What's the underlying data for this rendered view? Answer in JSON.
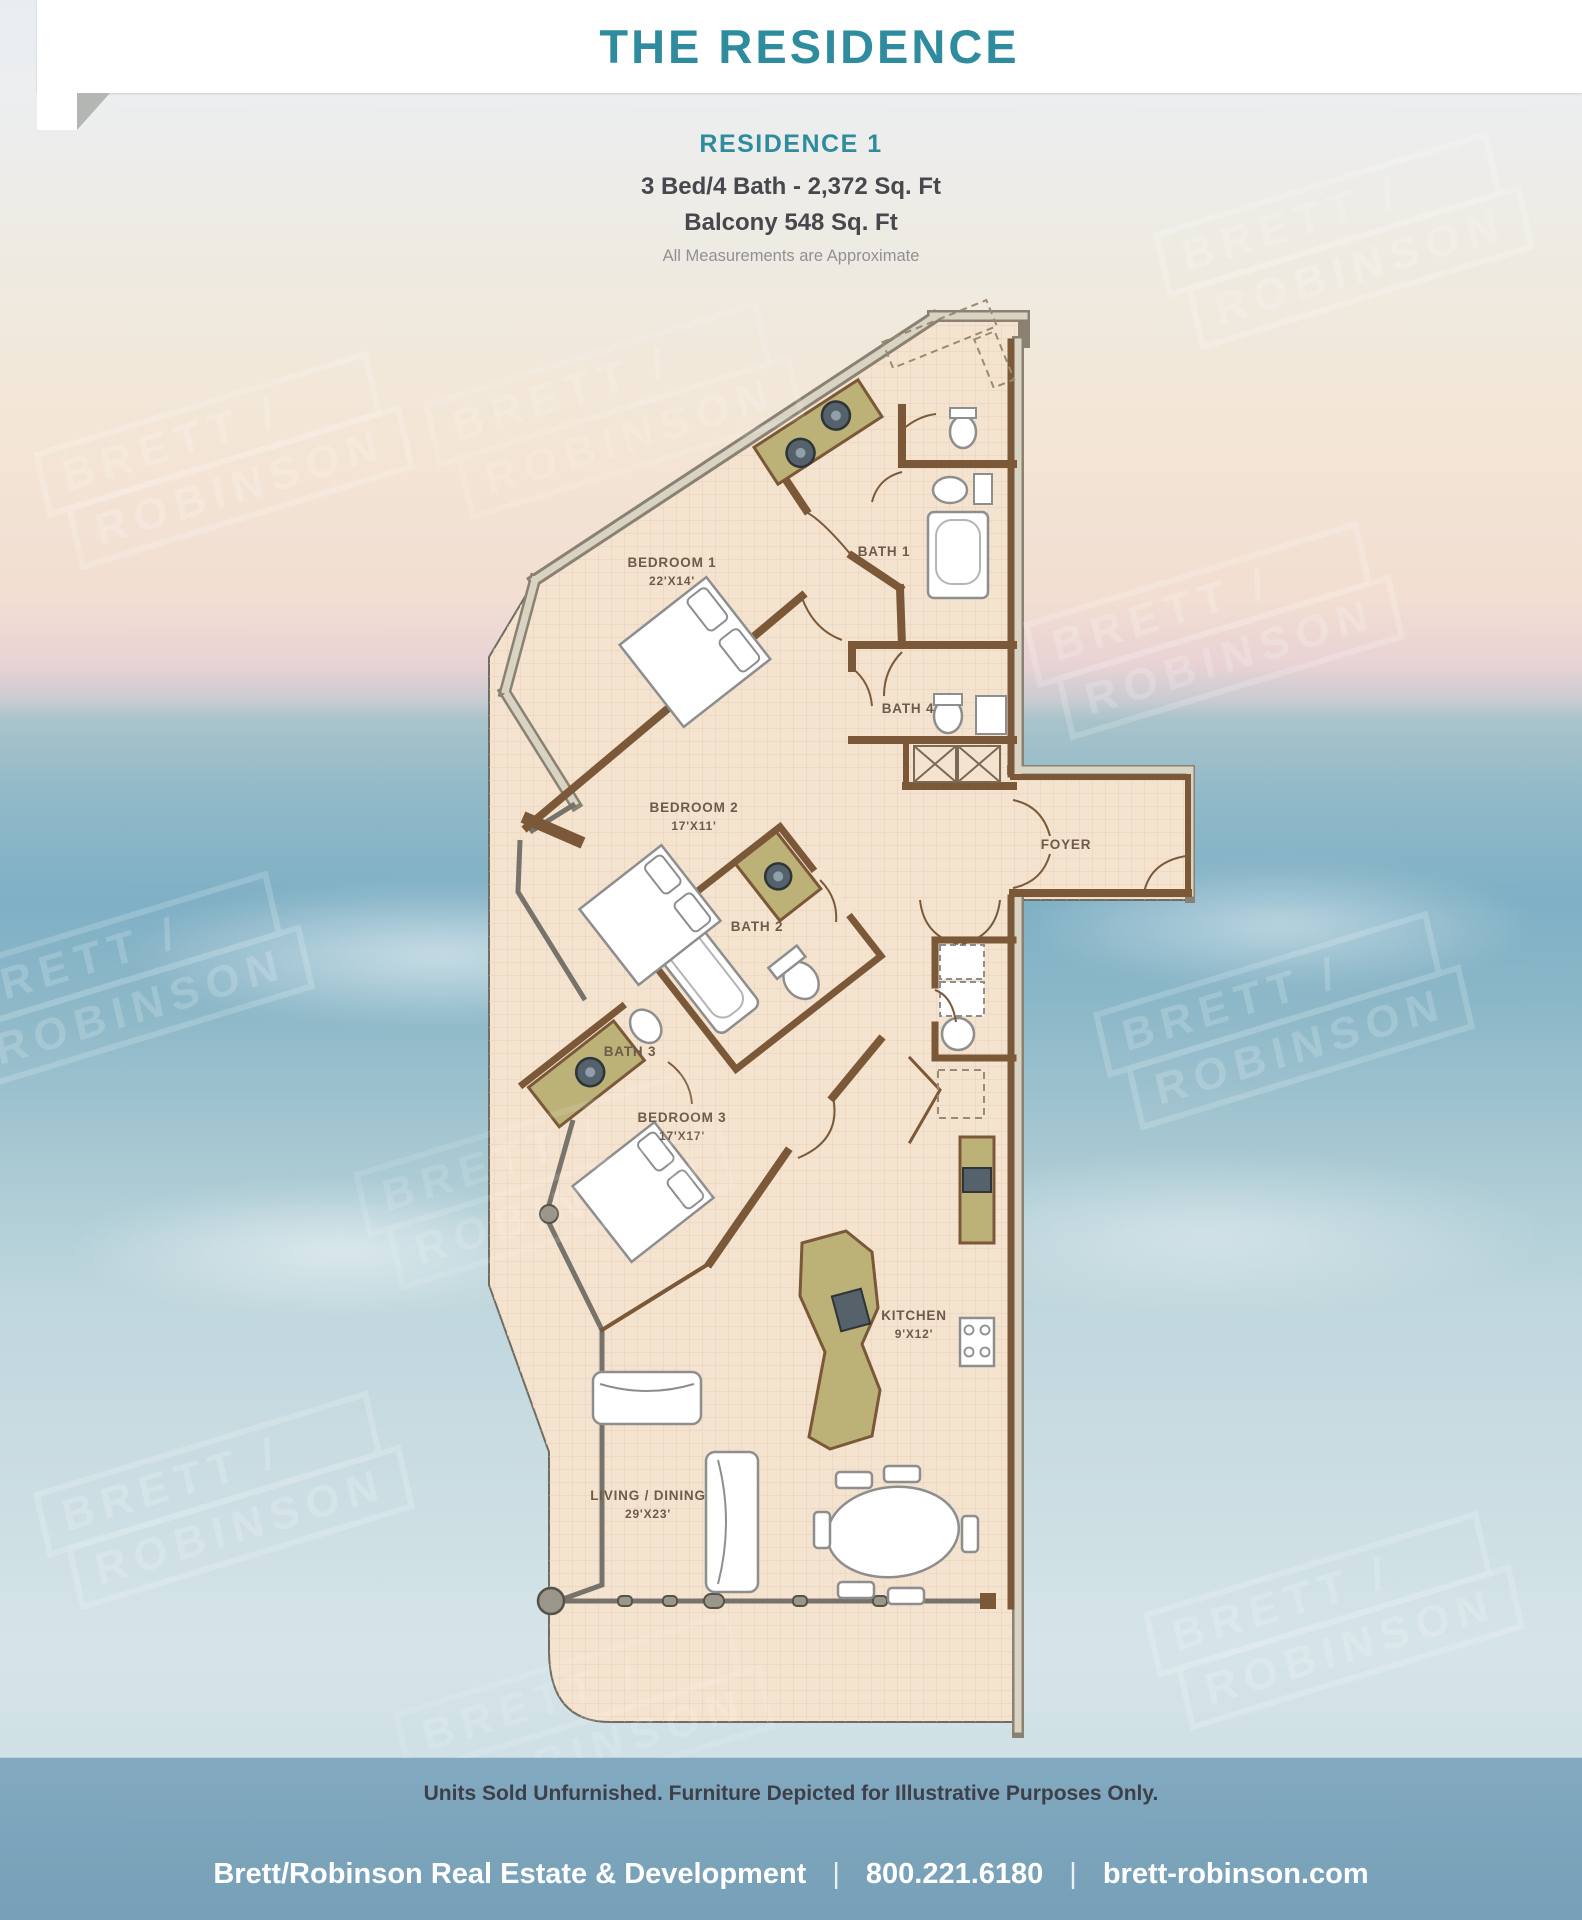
{
  "header": {
    "title": "THE RESIDENCE"
  },
  "intro": {
    "residence": "RESIDENCE 1",
    "specs": "3 Bed/4 Bath - 2,372 Sq. Ft",
    "balcony": "Balcony 548 Sq. Ft",
    "note": "All Measurements are Approximate"
  },
  "floorplan": {
    "rooms": [
      {
        "id": "bedroom1",
        "name": "BEDROOM 1",
        "dim": "22'X14'"
      },
      {
        "id": "bath1",
        "name": "BATH 1",
        "dim": ""
      },
      {
        "id": "bath4",
        "name": "BATH 4",
        "dim": ""
      },
      {
        "id": "foyer",
        "name": "FOYER",
        "dim": ""
      },
      {
        "id": "bedroom2",
        "name": "BEDROOM 2",
        "dim": "17'X11'"
      },
      {
        "id": "bath2",
        "name": "BATH 2",
        "dim": ""
      },
      {
        "id": "bath3",
        "name": "BATH 3",
        "dim": ""
      },
      {
        "id": "bedroom3",
        "name": "BEDROOM 3",
        "dim": "17'X17'"
      },
      {
        "id": "kitchen",
        "name": "KITCHEN",
        "dim": "9'X12'"
      },
      {
        "id": "living",
        "name": "LIVING / DINING",
        "dim": "29'X23'"
      }
    ]
  },
  "watermark": {
    "line1": "BRETT /",
    "line2": "ROBINSON"
  },
  "disclaimer": "Units Sold Unfurnished. Furniture Depicted for Illustrative Purposes Only.",
  "footer": {
    "company": "Brett/Robinson Real Estate & Development",
    "phone": "800.221.6180",
    "website": "brett-robinson.com",
    "separator": "|"
  },
  "colors": {
    "teal": "#2E8C9E",
    "footer_blue": "#80A9BF",
    "floor": "#F4E3CF",
    "wall_brown": "#7A5838",
    "wall_gray": "#8A8173",
    "counter_olive": "#BCB277",
    "text_dark": "#47474D",
    "text_gray": "#909095",
    "disclaimer_dark": "#3E4049"
  }
}
